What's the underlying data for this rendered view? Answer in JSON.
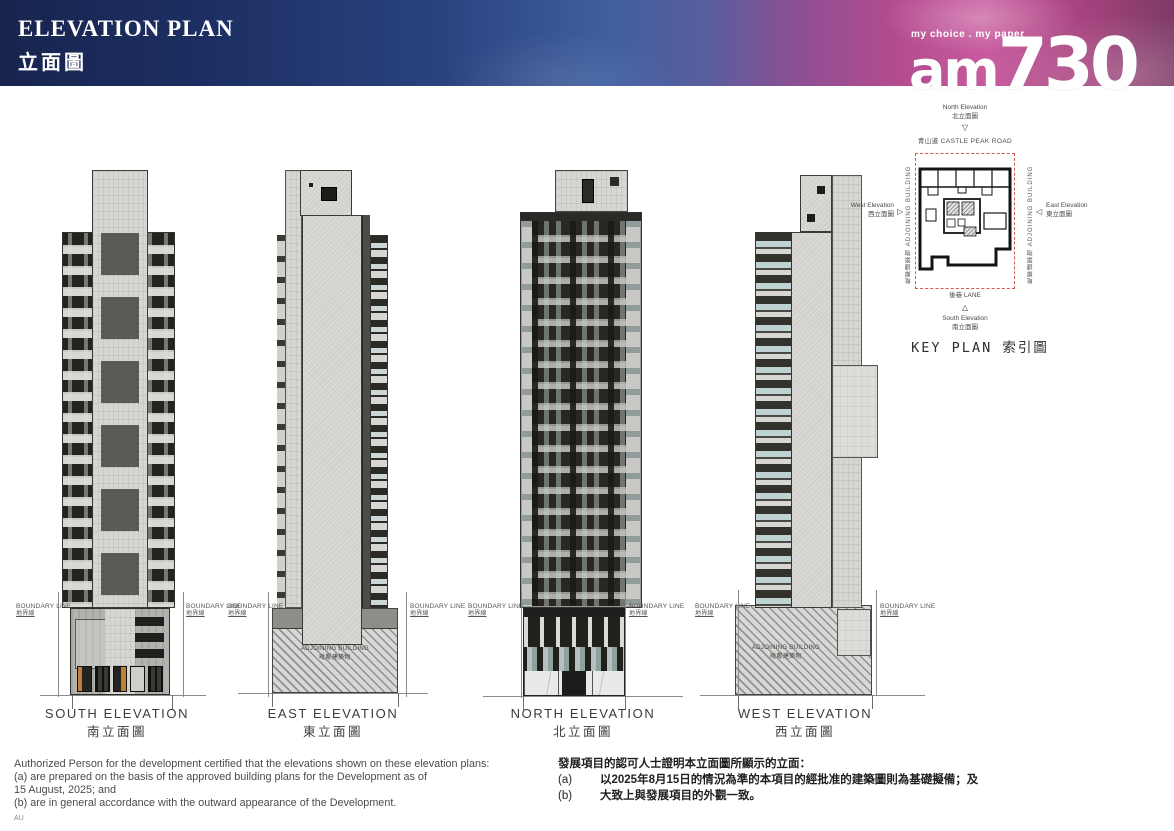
{
  "header": {
    "title_en": "ELEVATION PLAN",
    "title_zh": "立面圖",
    "tagline": "my choice . my paper",
    "logo_am": "am",
    "logo_num": "730"
  },
  "labels": {
    "boundary_en": "BOUNDARY LINE",
    "boundary_zh": "地界線",
    "adjoining_en": "ADJOINING BUILDING",
    "adjoining_zh": "毗鄰建築物"
  },
  "elevations": [
    {
      "en": "SOUTH ELEVATION",
      "zh": "南立面圖"
    },
    {
      "en": "EAST ELEVATION",
      "zh": "東立面圖"
    },
    {
      "en": "NORTH ELEVATION",
      "zh": "北立面圖"
    },
    {
      "en": "WEST ELEVATION",
      "zh": "西立面圖"
    }
  ],
  "key_plan": {
    "title": "KEY PLAN 索引圖",
    "north_en": "North Elevation",
    "north_zh": "北立面圖",
    "south_en": "South Elevation",
    "south_zh": "南立面圖",
    "east_en": "East Elevation",
    "east_zh": "東立面圖",
    "west_en": "West Elevation",
    "west_zh": "西立面圖",
    "road": "青山道  CASTLE PEAK ROAD",
    "lane": "後巷  LANE",
    "adjoining_side": "毗鄰建築物 ADJOINING BUILDING"
  },
  "icons": {
    "tri_down": "▽",
    "tri_up": "△",
    "tri_left": "◁",
    "tri_right": "▷"
  },
  "notes_en": {
    "line1": "Authorized Person for the development certified that the elevations shown on these elevation plans:",
    "line2": "(a) are prepared on the basis of the approved building plans for the Development as of",
    "line3": "15 August, 2025; and",
    "line4": "(b) are in general accordance with the outward appearance of the Development.",
    "footnote": "AU"
  },
  "notes_zh": {
    "line1": "發展項目的認可人士證明本立面圖所顯示的立面：",
    "a_label": "(a)",
    "a_text": "以2025年8月15日的情況為準的本項目的經批准的建築圖則為基礎擬備；及",
    "b_label": "(b)",
    "b_text": "大致上與發展項目的外觀一致。"
  },
  "colors": {
    "banner_blue": "#1d2f63",
    "banner_magenta": "#b34b8f",
    "boundary_red": "#cf5a52"
  }
}
